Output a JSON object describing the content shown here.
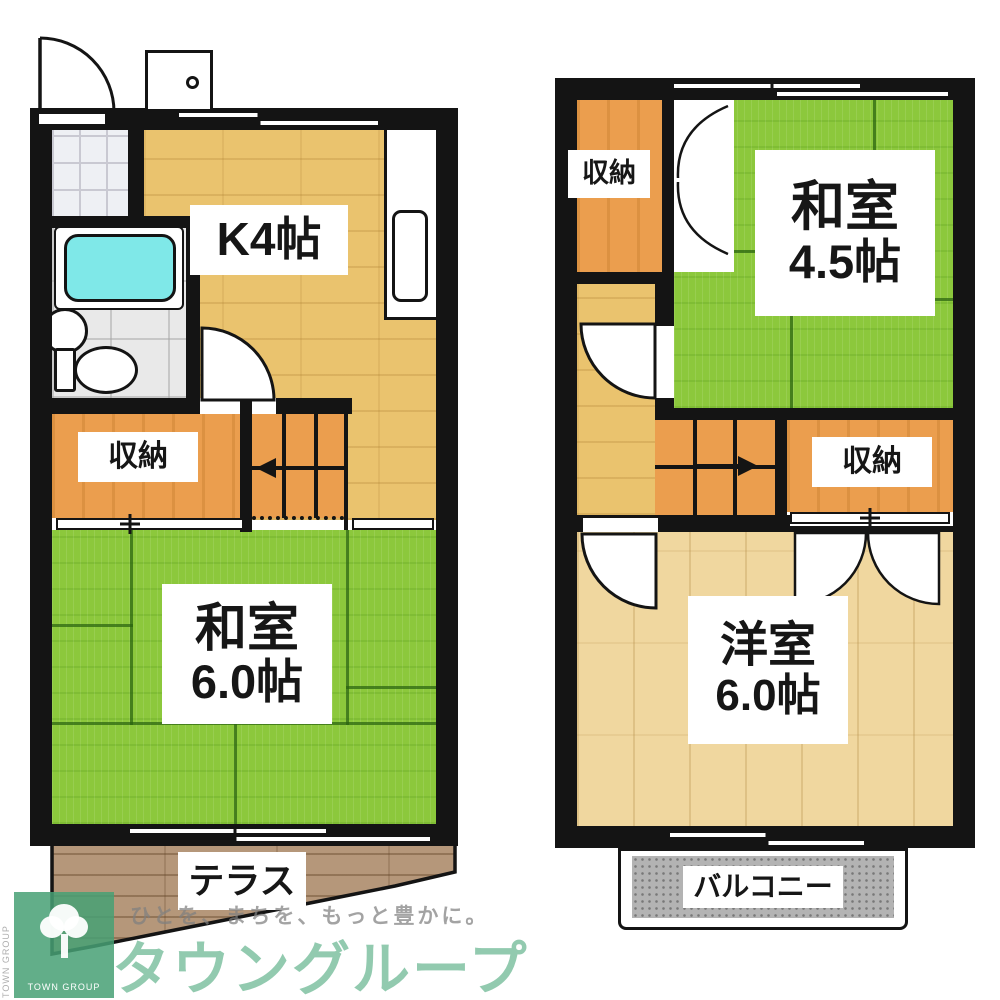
{
  "document": {
    "type": "apartment-floor-plan",
    "floors": [
      "1F",
      "2F"
    ]
  },
  "floor1": {
    "kitchen": {
      "label": "K4帖"
    },
    "storage": {
      "label": "収納"
    },
    "tatami": {
      "name": "和室",
      "size": "6.0帖"
    },
    "terrace": {
      "label": "テラス"
    }
  },
  "floor2": {
    "storage_upper": {
      "label": "収納"
    },
    "tatami": {
      "name": "和室",
      "size": "4.5帖"
    },
    "storage_side": {
      "label": "収納"
    },
    "western": {
      "name": "洋室",
      "size": "6.0帖"
    },
    "balcony": {
      "label": "バルコニー"
    }
  },
  "watermark": {
    "tagline": "ひとを、まちを、もっと豊かに。",
    "brand": "タウングループ",
    "logo_caption": "TOWN GROUP",
    "logo_side_text": "TOWN GROUP"
  },
  "colors": {
    "wall": "#141414",
    "tatami_green": "#8cc83c",
    "wood_floor": "#eac36e",
    "wood_floor_light": "#f0d79f",
    "storage_orange": "#eb9e4e",
    "terrace_brown": "#b5977a",
    "balcony_gray": "#b3b3b3",
    "bathtub_cyan": "#7fe8e8",
    "brand_green": "#46a074"
  }
}
